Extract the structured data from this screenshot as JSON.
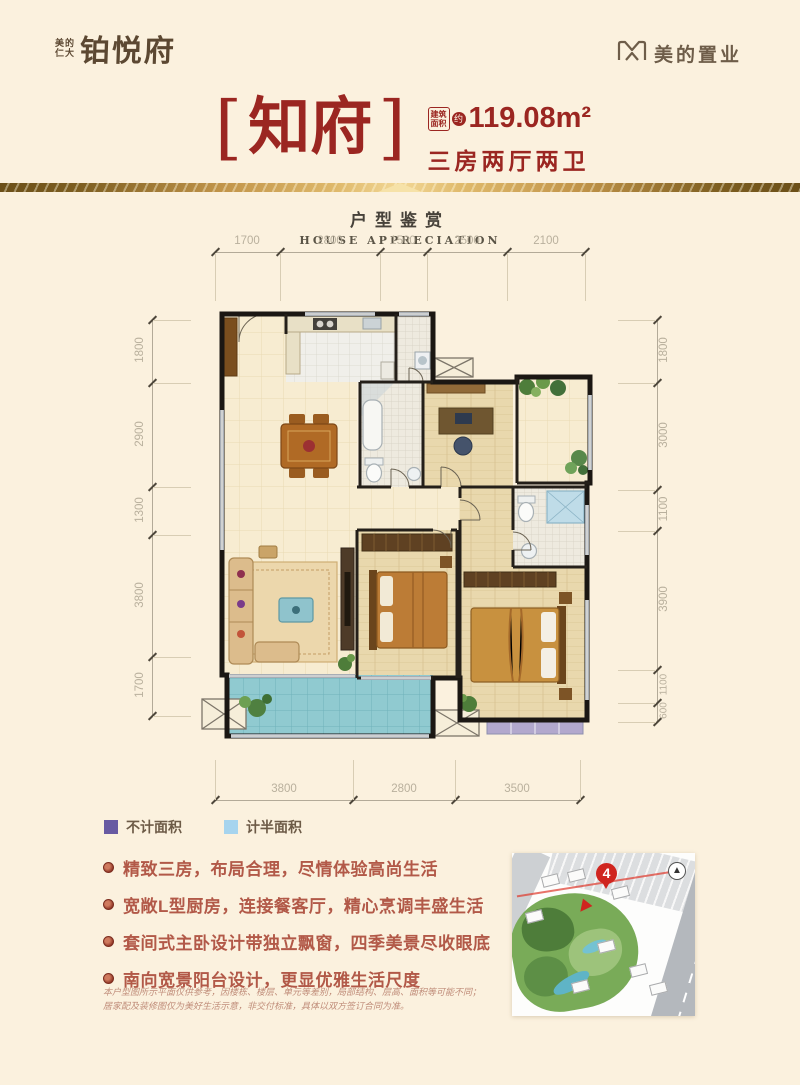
{
  "header": {
    "logo": {
      "sub_top": "美的",
      "sub_bottom": "仁大",
      "main": "铂悦府"
    },
    "brand": {
      "name": "美的置业",
      "color": "#6e5d49"
    }
  },
  "title": {
    "bracket_left": "[",
    "name": "知府",
    "bracket_right": "]",
    "area_box_line1": "建筑",
    "area_box_line2": "面积",
    "approx": "约",
    "area_value": "119.08m²",
    "layout_type": "三房两厅两卫",
    "accent_color": "#9b2621"
  },
  "section": {
    "title_cn": "户型鉴赏",
    "title_en": "HOUSE APPRECIATION"
  },
  "floor_plan": {
    "dimensions_top": [
      "1700",
      "2800",
      "1500",
      "2500",
      "2100"
    ],
    "dimensions_left": [
      "1800",
      "2900",
      "1300",
      "3800",
      "1700"
    ],
    "dimensions_right": [
      "1800",
      "3000",
      "1100",
      "3900",
      "1100",
      "600"
    ],
    "dimensions_bottom": [
      "3800",
      "2800",
      "3500"
    ]
  },
  "legend": {
    "items": [
      {
        "label": "不计面积",
        "color": "#685aa2"
      },
      {
        "label": "计半面积",
        "color": "#a6d4ee"
      }
    ]
  },
  "features": {
    "items": [
      "精致三房，布局合理，尽情体验高尚生活",
      "宽敞L型厨房，连接餐客厅，精心烹调丰盛生活",
      "套间式主卧设计带独立飘窗，四季美景尽收眼底",
      "南向宽景阳台设计，更显优雅生活尺度"
    ]
  },
  "disclaimer": {
    "line1": "本户型图所示平面仅供参考，因楼栋、楼层、单元等差别，局部结构、层高、面积等可能不同；",
    "line2": "居家配及装修图仅为美好生活示意，非交付标准，具体以双方签订合同为准。"
  },
  "site_plan": {
    "marker": "4",
    "marker_color": "#d0251f"
  }
}
